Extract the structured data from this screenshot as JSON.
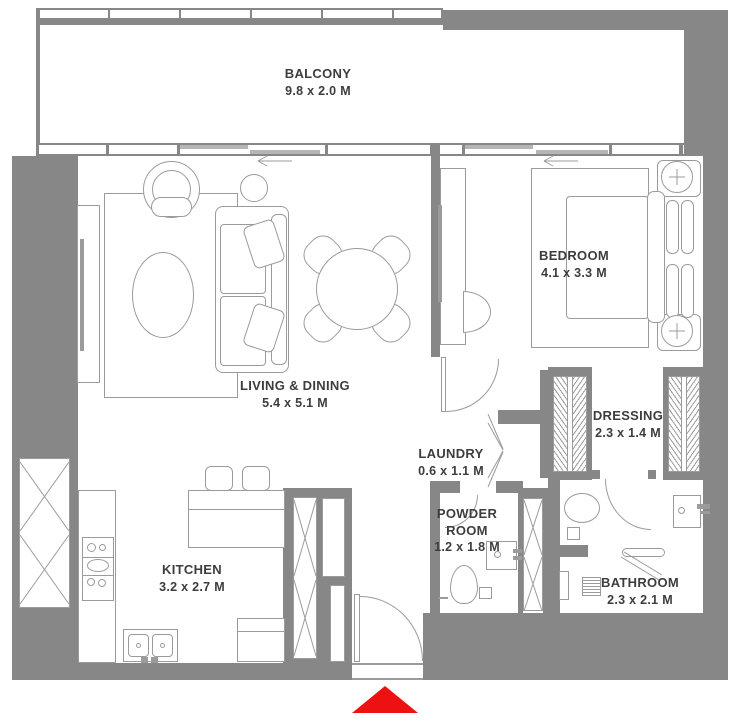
{
  "plan": {
    "title": "apartment-floor-plan",
    "colors": {
      "wall": "#878787",
      "line": "#9b9b9b",
      "text": "#3d3d3d",
      "entrance_arrow": "#ee1111",
      "window_panel": "#b5b5b5"
    },
    "rooms": [
      {
        "id": "balcony",
        "name": "BALCONY",
        "dims": "9.8 x 2.0 M"
      },
      {
        "id": "living",
        "name": "LIVING & DINING",
        "dims": "5.4 x 5.1 M"
      },
      {
        "id": "bedroom",
        "name": "BEDROOM",
        "dims": "4.1 x 3.3 M"
      },
      {
        "id": "dressing",
        "name": "DRESSING",
        "dims": "2.3 x 1.4 M"
      },
      {
        "id": "laundry",
        "name": "LAUNDRY",
        "dims": "0.6 x 1.1 M"
      },
      {
        "id": "powder",
        "name": "POWDER ROOM",
        "dims": "1.2 x 1.8 M"
      },
      {
        "id": "kitchen",
        "name": "KITCHEN",
        "dims": "3.2 x 2.7 M"
      },
      {
        "id": "bathroom",
        "name": "BATHROOM",
        "dims": "2.3 x 2.1 M"
      }
    ],
    "entrance": {
      "symbol": "entrance-arrow",
      "direction": "up"
    }
  }
}
